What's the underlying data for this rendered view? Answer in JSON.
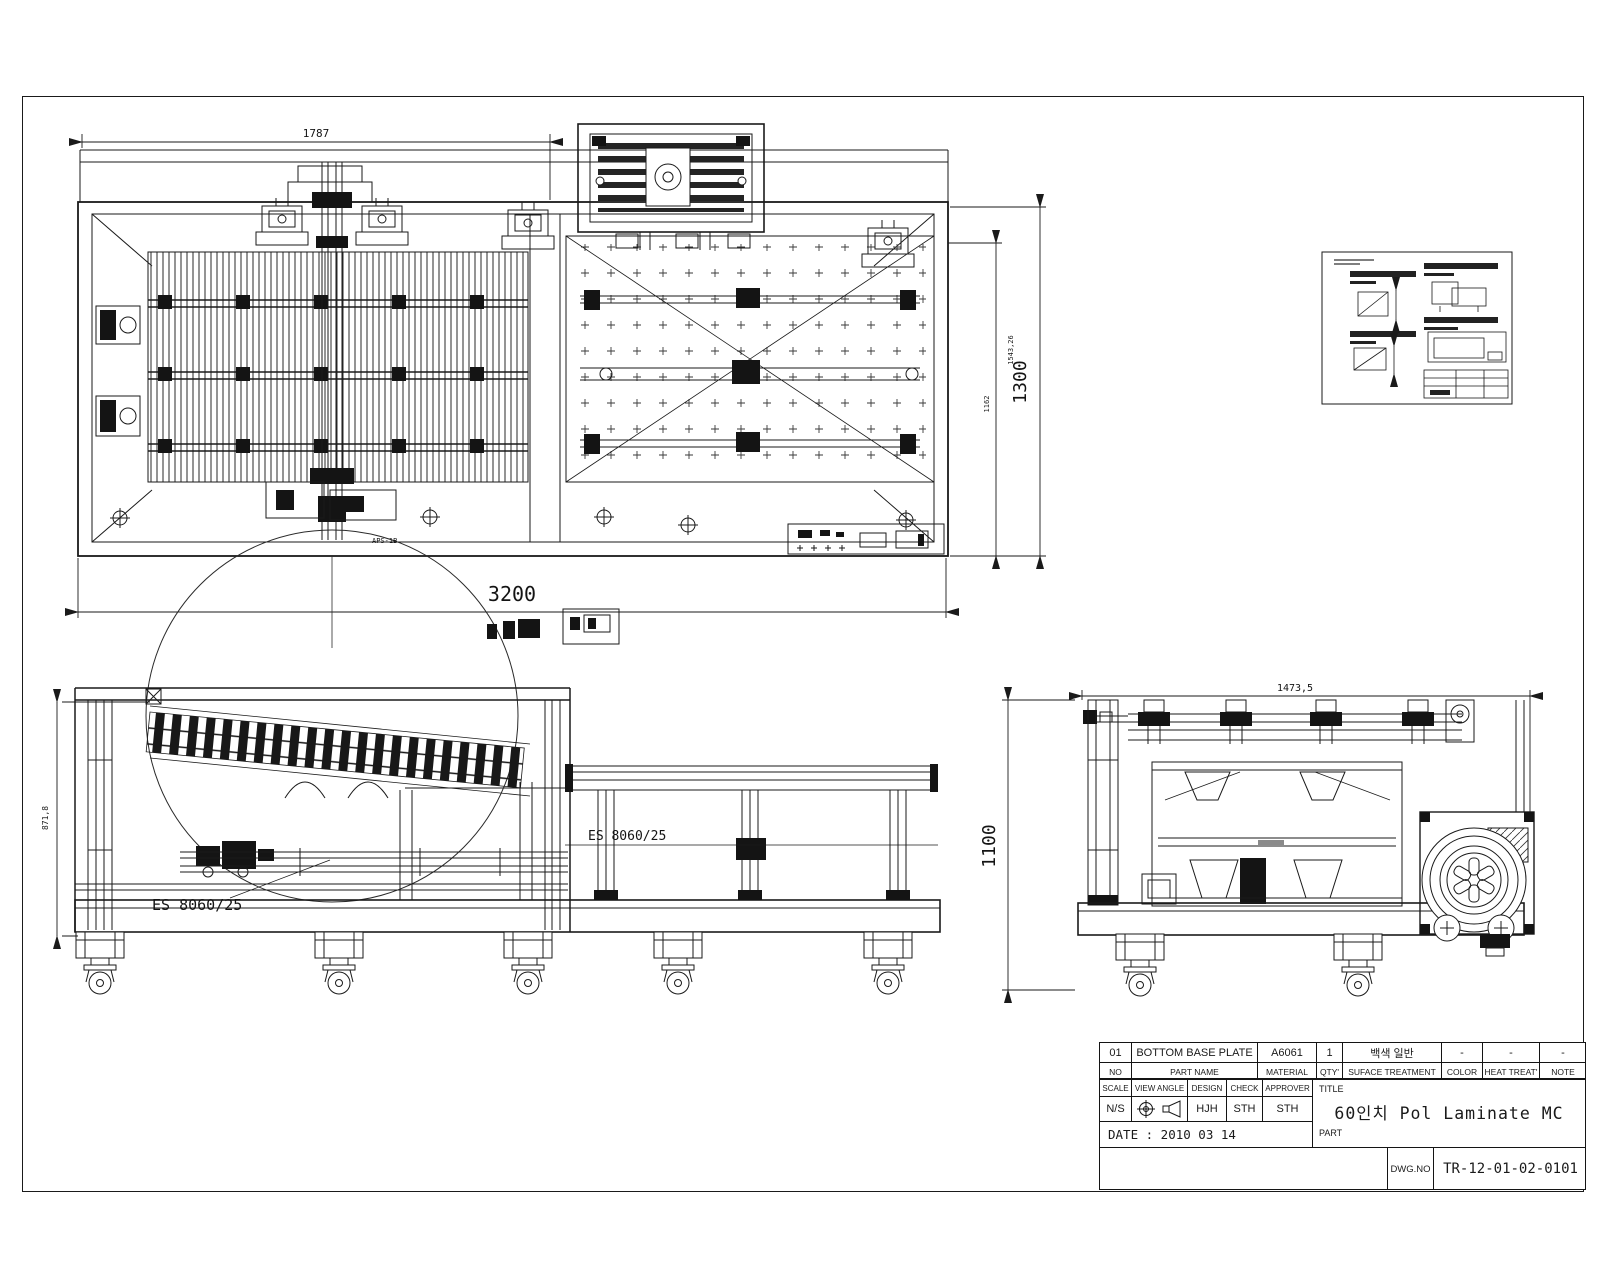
{
  "colors": {
    "line": "#1a1a1a",
    "background": "#ffffff"
  },
  "drawing_labels": {
    "plan_width_top": "1787",
    "plan_width_bottom": "3200",
    "plan_height": "1300",
    "plan_height_sub": "1543,26",
    "plan_height_inner": "1162",
    "side_height": "871,8",
    "side_part_label_1": "ES 8060/25",
    "side_part_label_2": "ES 8060/25",
    "side_small_label": "APS-1B",
    "end_width": "1473,5",
    "end_height": "1100"
  },
  "title_block": {
    "row_item": {
      "no": "01",
      "part_name": "BOTTOM BASE PLATE",
      "material": "A6061",
      "qty": "1",
      "surface_treatment": "백색 일반",
      "color": "-",
      "heat_treat": "-",
      "note": "-"
    },
    "row_head": {
      "no": "NO",
      "part_name": "PART NAME",
      "material": "MATERIAL",
      "qty": "QTY'",
      "surface_treatment": "SUFACE TREATMENT",
      "color": "COLOR",
      "heat_treat": "HEAT TREAT'",
      "note": "NOTE"
    },
    "meta_head": {
      "scale": "SCALE",
      "view_angle": "VIEW ANGLE",
      "design": "DESIGN",
      "check": "CHECK",
      "approver": "APPROVER"
    },
    "meta_val": {
      "scale": "N/S",
      "design": "HJH",
      "check": "STH",
      "approver": "STH"
    },
    "date": "DATE : 2010  03  14",
    "title_label": "TITLE",
    "part_label": "PART",
    "title": "60인치 Pol Laminate MC",
    "dwg_no_label": "DWG.NO",
    "dwg_no": "TR-12-01-02-0101"
  }
}
